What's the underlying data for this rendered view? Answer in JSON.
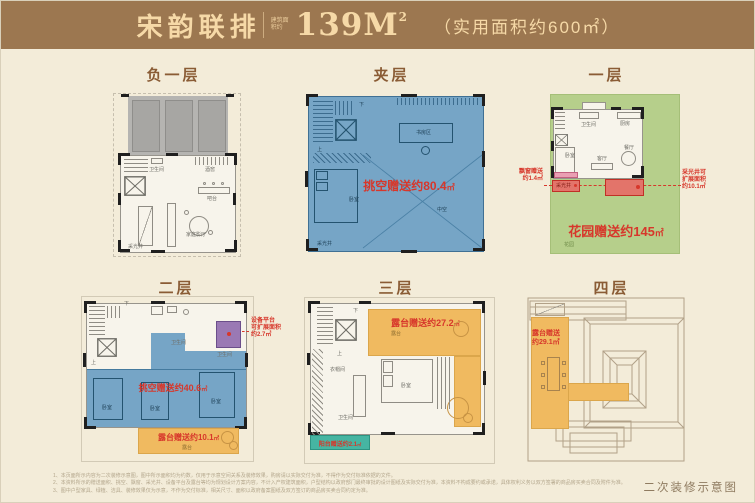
{
  "colors": {
    "header_bg": "#9c7750",
    "header_text": "#f6d9a7",
    "page_bg": "#f3ecd9",
    "title_text": "#8a5c35",
    "plan_blue": "#76a5c6",
    "garden_green": "#b6cf8b",
    "terrace_orange": "#f0ba60",
    "balcony_teal": "#46b5a2",
    "equipment_purple": "#9a79b4",
    "bay_pink": "#ea9fb3",
    "lightwell_red": "#e3746a",
    "annotation_red": "#d7372b",
    "wall_black": "#1f1f1f"
  },
  "header": {
    "project": "宋韵联排",
    "area_prefix": "建筑面积约",
    "area_value": "139M",
    "area_sup": "2",
    "usable": "（实用面积约600㎡）"
  },
  "floors": {
    "b1": {
      "title": "负一层",
      "bath": "卫生间",
      "cellar": "酒窖",
      "bar": "吧台",
      "cinema": "家庭影厅",
      "lightwell": "采光井"
    },
    "mezz": {
      "title": "夹层",
      "gift": "挑空赠送约80.4",
      "unit": "㎡",
      "study": "书房区",
      "bed": "卧室",
      "void": "中空",
      "lightwell": "采光井",
      "down": "下",
      "up": "上"
    },
    "f1": {
      "title": "一层",
      "garden_gift": "花园赠送约145",
      "unit": "㎡",
      "bay_note_line1": "飘窗赠送",
      "bay_note_line2": "约1.4㎡",
      "well_note_line1": "采光井可",
      "well_note_line2": "扩展面积",
      "well_note_line3": "约10.1㎡",
      "bath": "卫生间",
      "kitchen": "厨房",
      "bed": "卧室",
      "living": "客厅",
      "dining": "餐厅",
      "garden": "花园",
      "lightwell": "采光井"
    },
    "f2": {
      "title": "二层",
      "void_gift": "挑空赠送约40.6",
      "terrace_gift": "露台赠送约10.1",
      "unit": "㎡",
      "equip_note_line1": "设备平台",
      "equip_note_line2": "可扩展面积",
      "equip_note_line3": "约2.7㎡",
      "bath": "卫生间",
      "bed": "卧室",
      "terrace": "露台",
      "down": "下",
      "up": "上"
    },
    "f3": {
      "title": "三层",
      "terrace_gift": "露台赠送约27.2",
      "balcony_gift": "阳台赠送约2.1",
      "unit": "㎡",
      "cloak": "衣帽间",
      "bath": "卫生间",
      "bed": "卧室",
      "terrace": "露台",
      "down": "下",
      "up": "上"
    },
    "f4": {
      "title": "四层",
      "gift_line1": "露台赠送",
      "gift_line2": "约29.1㎡"
    }
  },
  "footer": {
    "note1": "1、本页面所示内容为二次装修示意图，图中所示面积均为约数，仅用于示意空间关系及装修效果，购房请以实际交付为准，不得作为交付标准依据的文件。",
    "note2": "2、本资料所示的赠送面积、挑空、飘窗、采光井、设备平台及露台等均为规划设计方案内容，不计入产权建筑面积，户型结构以政府部门最终审批的设计图纸及实际交付为准，本资料不构成要约或承诺，具体权利义务以双方签署的商品房买卖合同及附件为准。",
    "note3": "3、图中户型家具、绿植、洁具、装修效果仅为示意，不作为交付标准，相关尺寸、面积以政府备案图纸及双方签订的商品房买卖合同约定为准。",
    "caption": "二次装修示意图"
  }
}
